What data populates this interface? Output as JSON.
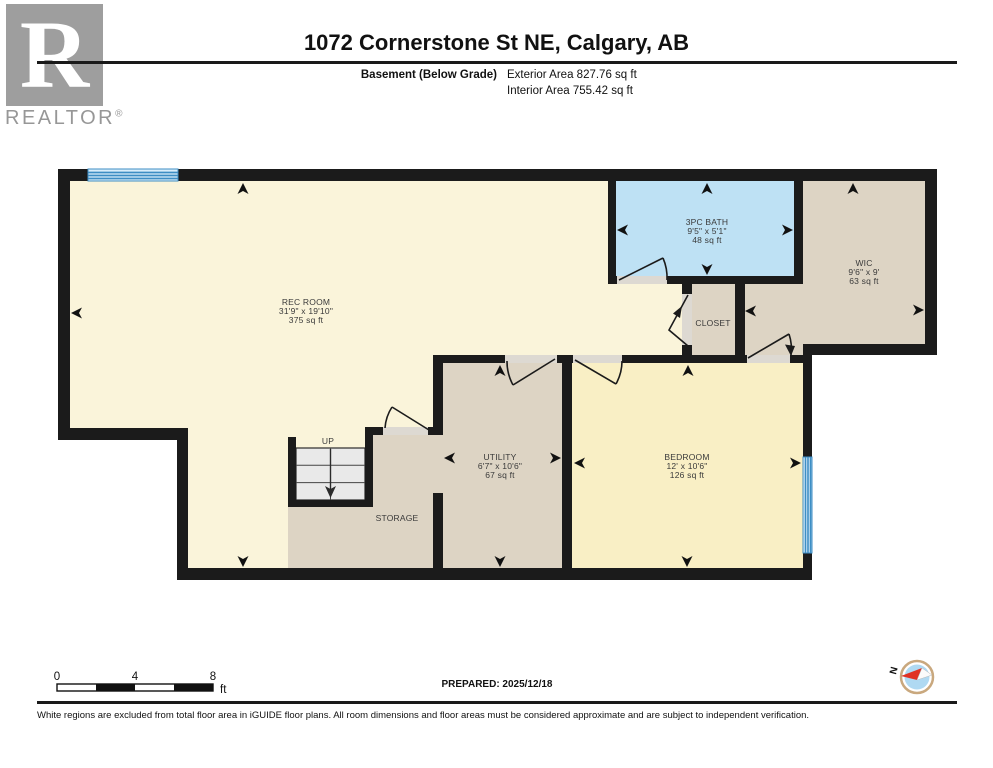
{
  "palette": {
    "wall": "#1B1B1B",
    "finished_room": "#FAF4DA",
    "bedroom_room": "#F9EFC5",
    "unfinished_room": "#DDD4C4",
    "bathroom": "#BEE1F4",
    "window_blue": "#3E8EC4",
    "window_fill": "#D9EDFA",
    "door_opening": "#DDD9D2",
    "stair_fill": "#E9E9E9",
    "logo_gray": "#9E9E9E",
    "compass_ring": "#C9A87E",
    "compass_fill": "#AFD9F2",
    "compass_needle": "#E03224"
  },
  "header": {
    "logo_letter": "R",
    "logo_word": "REALTOR",
    "logo_reg": "®",
    "title": "1072 Cornerstone St NE, Calgary, AB",
    "floor_label": "Basement (Below Grade)",
    "exterior_area": "Exterior Area 827.76 sq ft",
    "interior_area": "Interior Area 755.42 sq ft"
  },
  "rooms": [
    {
      "name": "REC ROOM",
      "dims": "31'9\" x 19'10\"",
      "area": "375 sq ft"
    },
    {
      "name": "3PC BATH",
      "dims": "9'5\" x 5'1\"",
      "area": "48 sq ft"
    },
    {
      "name": "WIC",
      "dims": "9'6\" x 9'",
      "area": "63 sq ft"
    },
    {
      "name": "UTILITY",
      "dims": "6'7\" x 10'6\"",
      "area": "67 sq ft"
    },
    {
      "name": "BEDROOM",
      "dims": "12' x 10'6\"",
      "area": "126 sq ft"
    },
    {
      "name": "CLOSET"
    },
    {
      "name": "STORAGE"
    },
    {
      "name": "UP"
    }
  ],
  "footer": {
    "scale_0": "0",
    "scale_4": "4",
    "scale_8": "8",
    "scale_unit": "ft",
    "prepared": "PREPARED: 2025/12/18",
    "compass_north": "N",
    "disclaimer": "White regions are excluded from total floor area in iGUIDE floor plans. All room dimensions and floor areas must be considered approximate and are subject to independent verification."
  }
}
